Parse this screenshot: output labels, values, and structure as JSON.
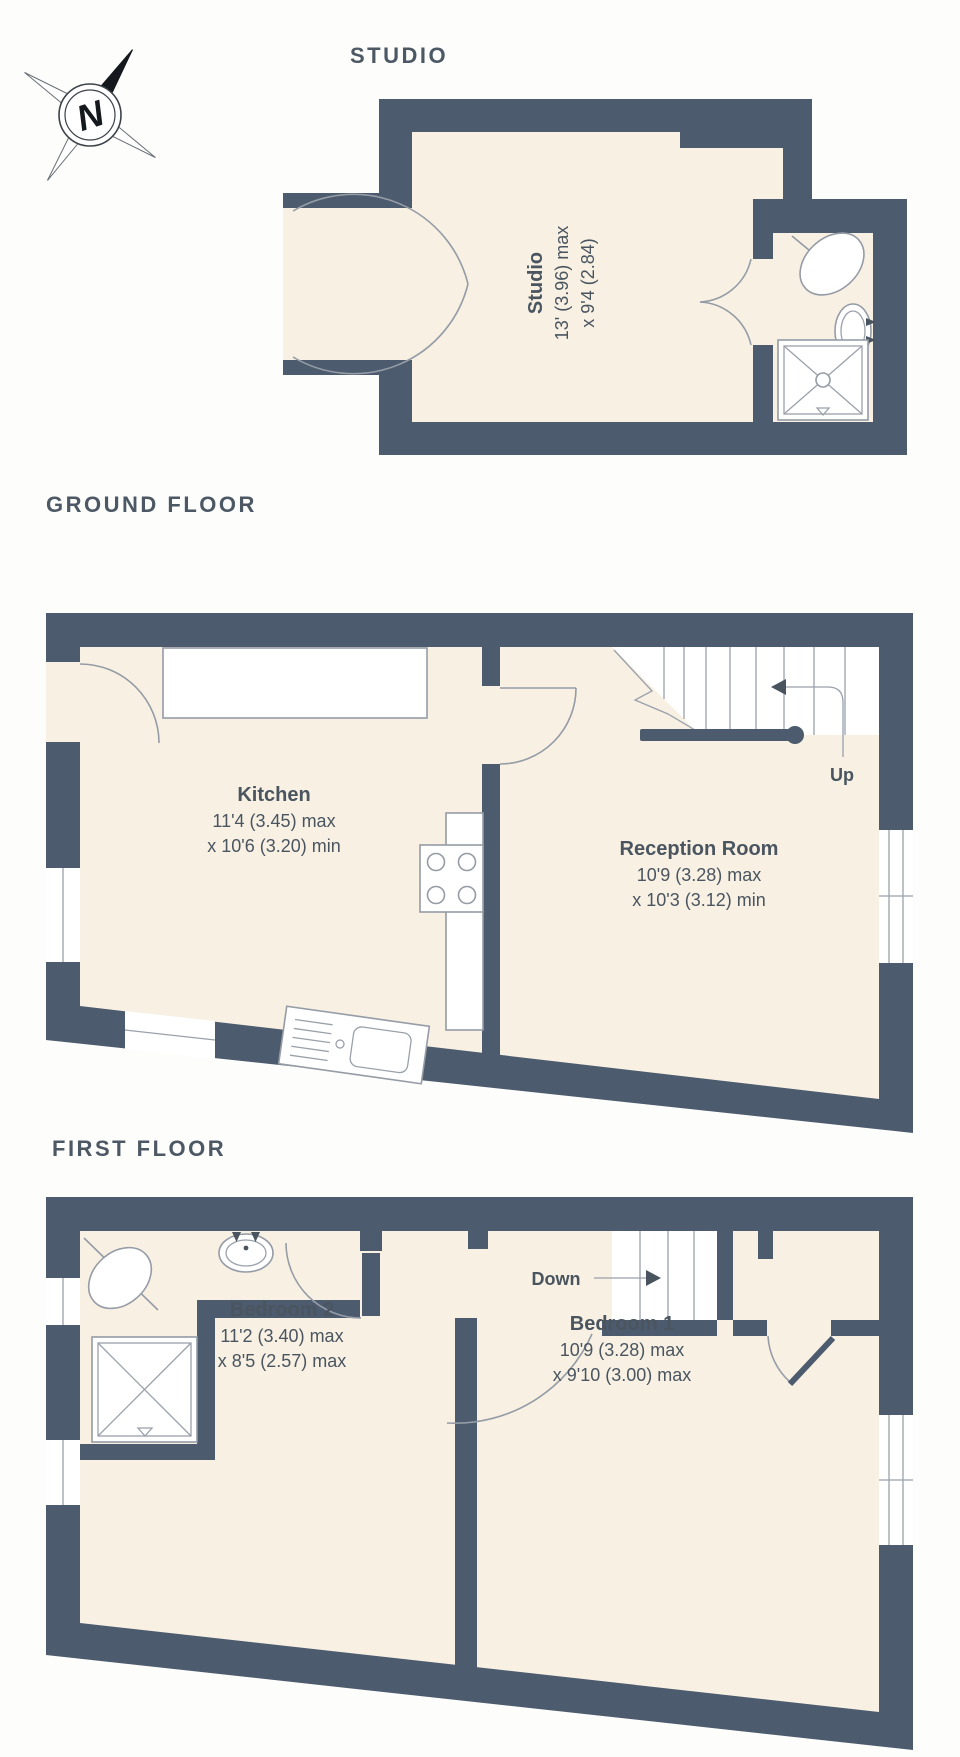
{
  "document": {
    "type": "property-floorplan",
    "background": "#fdfdfc"
  },
  "colors": {
    "wall": "#4c5b6d",
    "floor_fill": "#f7f0e3",
    "fixture_line": "#959ca6",
    "text": "#4a5560"
  },
  "compass": {
    "letter": "N"
  },
  "studio": {
    "title": "STUDIO",
    "room": {
      "name": "Studio",
      "dim1": "13' (3.96) max",
      "dim2": "x 9'4 (2.84)"
    }
  },
  "ground": {
    "title": "GROUND FLOOR",
    "stair_label": "Up",
    "kitchen": {
      "name": "Kitchen",
      "dim1": "11'4 (3.45) max",
      "dim2": "x 10'6 (3.20) min"
    },
    "reception": {
      "name": "Reception Room",
      "dim1": "10'9 (3.28) max",
      "dim2": "x 10'3 (3.12) min"
    }
  },
  "first": {
    "title": "FIRST FLOOR",
    "stair_label": "Down",
    "bedroom2": {
      "name": "Bedroom 2",
      "dim1": "11'2 (3.40) max",
      "dim2": "x 8'5 (2.57) max"
    },
    "bedroom1": {
      "name": "Bedroom 1",
      "dim1": "10'9 (3.28) max",
      "dim2": "x 9'10 (3.00) max"
    }
  }
}
